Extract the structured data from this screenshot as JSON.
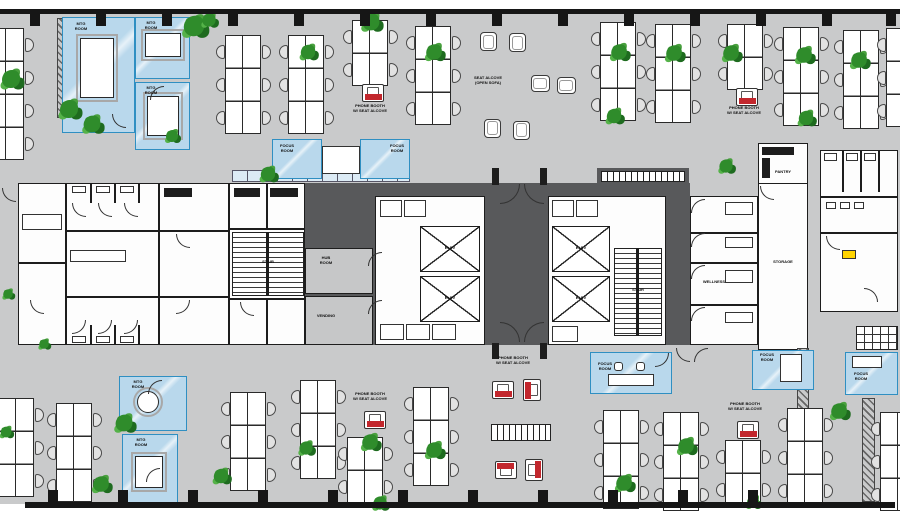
{
  "meta": {
    "title": "Office floor plan",
    "type": "architectural-floor-plan"
  },
  "colors": {
    "floor": "#c9cacb",
    "core_dark": "#58595b",
    "wall": "#161616",
    "room_white": "#fdfdfd",
    "meeting_room_blue": "#b9d8ec",
    "blue_border": "#2f8fc2",
    "phone_booth_red": "#c2272d",
    "plant_green": "#2f8c2b",
    "tag_yellow": "#ffd400"
  },
  "labels": {
    "phone_booth": "PHONE BOOTH\nW/ SEAT ALCOVE",
    "seat_alcove": "SEAT ALCOVE\n(OPEN SOFA)",
    "focus_room": "FOCUS\nROOM",
    "mtg_room": "MTG\nROOM",
    "hub_room": "HUB\nROOM",
    "vending": "VENDING",
    "storage": "STORAGE",
    "stair": "STAIR",
    "elev": "ELEV",
    "wellness": "WELLNESS",
    "pantry": "PANTRY"
  },
  "furniture": {
    "desk_clusters": [
      {
        "x": -12,
        "y": 28,
        "rows": 4
      },
      {
        "x": 225,
        "y": 35,
        "rows": 3
      },
      {
        "x": 288,
        "y": 35,
        "rows": 3
      },
      {
        "x": 352,
        "y": 20,
        "rows": 2
      },
      {
        "x": 415,
        "y": 26,
        "rows": 3
      },
      {
        "x": 600,
        "y": 22,
        "rows": 3
      },
      {
        "x": 655,
        "y": 24,
        "rows": 3
      },
      {
        "x": 727,
        "y": 24,
        "rows": 2
      },
      {
        "x": 783,
        "y": 27,
        "rows": 3
      },
      {
        "x": 843,
        "y": 30,
        "rows": 3
      },
      {
        "x": 886,
        "y": 28,
        "rows": 3
      },
      {
        "x": -2,
        "y": 398,
        "rows": 3
      },
      {
        "x": 56,
        "y": 403,
        "rows": 3
      },
      {
        "x": 230,
        "y": 392,
        "rows": 3
      },
      {
        "x": 300,
        "y": 380,
        "rows": 3
      },
      {
        "x": 347,
        "y": 437,
        "rows": 2
      },
      {
        "x": 413,
        "y": 387,
        "rows": 3
      },
      {
        "x": 603,
        "y": 410,
        "rows": 3
      },
      {
        "x": 663,
        "y": 412,
        "rows": 3
      },
      {
        "x": 725,
        "y": 440,
        "rows": 2
      },
      {
        "x": 787,
        "y": 408,
        "rows": 3
      },
      {
        "x": 880,
        "y": 412,
        "rows": 3
      }
    ],
    "plants": [
      {
        "x": 5,
        "y": 73,
        "s": 1.5
      },
      {
        "x": 188,
        "y": 20,
        "s": 1.7
      },
      {
        "x": 63,
        "y": 103,
        "s": 1.5
      },
      {
        "x": 86,
        "y": 118,
        "s": 1.4
      },
      {
        "x": 166,
        "y": 130,
        "s": 1.0
      },
      {
        "x": 203,
        "y": 14,
        "s": 1.1
      },
      {
        "x": 302,
        "y": 46,
        "s": 1.2
      },
      {
        "x": 365,
        "y": 16,
        "s": 1.4
      },
      {
        "x": 428,
        "y": 46,
        "s": 1.3
      },
      {
        "x": 613,
        "y": 46,
        "s": 1.3
      },
      {
        "x": 668,
        "y": 47,
        "s": 1.3
      },
      {
        "x": 725,
        "y": 47,
        "s": 1.3
      },
      {
        "x": 798,
        "y": 49,
        "s": 1.3
      },
      {
        "x": 853,
        "y": 54,
        "s": 1.3
      },
      {
        "x": 608,
        "y": 110,
        "s": 1.2
      },
      {
        "x": 800,
        "y": 112,
        "s": 1.2
      },
      {
        "x": 262,
        "y": 168,
        "s": 1.2
      },
      {
        "x": 720,
        "y": 160,
        "s": 1.1
      },
      {
        "x": 2,
        "y": 288,
        "s": 0.8
      },
      {
        "x": 118,
        "y": 417,
        "s": 1.4
      },
      {
        "x": 95,
        "y": 478,
        "s": 1.3
      },
      {
        "x": 0,
        "y": 426,
        "s": 0.9
      },
      {
        "x": 300,
        "y": 442,
        "s": 1.1
      },
      {
        "x": 364,
        "y": 436,
        "s": 1.3
      },
      {
        "x": 428,
        "y": 444,
        "s": 1.3
      },
      {
        "x": 374,
        "y": 497,
        "s": 1.1
      },
      {
        "x": 618,
        "y": 477,
        "s": 1.3
      },
      {
        "x": 680,
        "y": 440,
        "s": 1.3
      },
      {
        "x": 833,
        "y": 405,
        "s": 1.3
      },
      {
        "x": 747,
        "y": 496,
        "s": 1.0
      },
      {
        "x": 38,
        "y": 338,
        "s": 0.8
      },
      {
        "x": 215,
        "y": 470,
        "s": 1.2
      }
    ],
    "phone_booths": [
      {
        "x": 362,
        "y": 84,
        "r": 0
      },
      {
        "x": 736,
        "y": 88,
        "r": 0
      },
      {
        "x": 492,
        "y": 381,
        "r": 0
      },
      {
        "x": 521,
        "y": 381,
        "r": 90
      },
      {
        "x": 495,
        "y": 461,
        "r": 180
      },
      {
        "x": 523,
        "y": 461,
        "r": 270
      },
      {
        "x": 737,
        "y": 421,
        "r": 0
      },
      {
        "x": 364,
        "y": 411,
        "r": 0
      }
    ],
    "lounge_chairs": [
      {
        "x": 480,
        "y": 32,
        "r": 0
      },
      {
        "x": 509,
        "y": 33,
        "r": 0
      },
      {
        "x": 532,
        "y": 74,
        "r": 90
      },
      {
        "x": 558,
        "y": 76,
        "r": 90
      },
      {
        "x": 484,
        "y": 119,
        "r": 180
      },
      {
        "x": 513,
        "y": 121,
        "r": 180
      }
    ],
    "door_arcs": [
      {
        "x": 112,
        "y": 114,
        "r": 0
      },
      {
        "x": 150,
        "y": 86,
        "r": 90
      },
      {
        "x": 148,
        "y": 380,
        "r": 90
      },
      {
        "x": 146,
        "y": 468,
        "r": 90
      },
      {
        "x": 368,
        "y": 252,
        "r": 90
      },
      {
        "x": 368,
        "y": 300,
        "r": 90
      },
      {
        "x": 500,
        "y": 184,
        "r": 270,
        "s": 20
      },
      {
        "x": 524,
        "y": 184,
        "r": 0,
        "s": 20
      },
      {
        "x": 500,
        "y": 322,
        "r": 180,
        "s": 20
      },
      {
        "x": 524,
        "y": 322,
        "r": 90,
        "s": 20
      },
      {
        "x": 691,
        "y": 199,
        "r": 90
      },
      {
        "x": 691,
        "y": 233,
        "r": 90
      },
      {
        "x": 691,
        "y": 265,
        "r": 90
      },
      {
        "x": 691,
        "y": 307,
        "r": 90
      },
      {
        "x": 760,
        "y": 186,
        "r": 0
      },
      {
        "x": 826,
        "y": 236,
        "r": 0
      },
      {
        "x": 864,
        "y": 288,
        "r": 180
      },
      {
        "x": 72,
        "y": 203,
        "r": 0
      },
      {
        "x": 98,
        "y": 203,
        "r": 0
      },
      {
        "x": 124,
        "y": 203,
        "r": 0
      },
      {
        "x": 72,
        "y": 320,
        "r": 270
      },
      {
        "x": 98,
        "y": 320,
        "r": 270
      },
      {
        "x": 124,
        "y": 320,
        "r": 270
      },
      {
        "x": 30,
        "y": 300,
        "r": 0
      },
      {
        "x": 655,
        "y": 353,
        "r": 270
      },
      {
        "x": 676,
        "y": 348,
        "r": 0
      },
      {
        "x": 694,
        "y": 348,
        "r": 90
      },
      {
        "x": 2,
        "y": 188,
        "r": 0
      },
      {
        "x": 176,
        "y": 234,
        "r": 0
      },
      {
        "x": 176,
        "y": 300,
        "r": 270
      },
      {
        "x": 240,
        "y": 302,
        "r": 0
      }
    ],
    "columns_top": [
      30,
      96,
      162,
      228,
      294,
      360,
      426,
      492,
      558,
      624,
      690,
      756,
      822,
      886
    ],
    "columns_bottom": [
      48,
      118,
      188,
      258,
      328,
      398,
      468,
      538,
      608,
      678,
      748
    ]
  }
}
